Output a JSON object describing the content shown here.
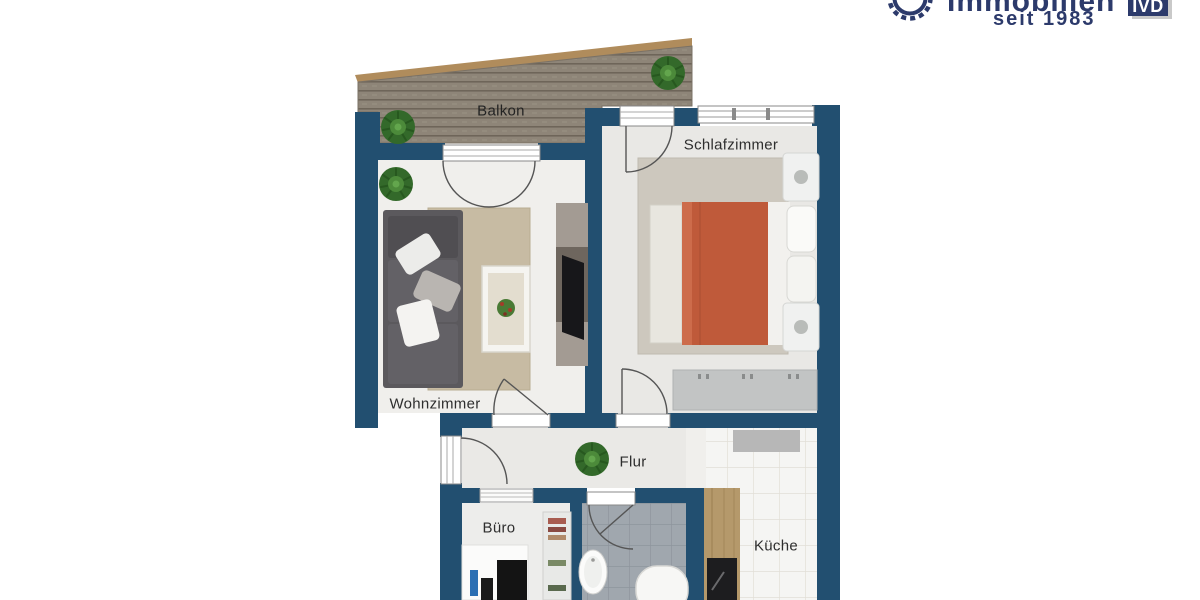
{
  "logo": {
    "brand": "Immobilien",
    "tagline": "seit 1983",
    "badge": "IVD",
    "icon": "gear-ring-icon"
  },
  "floorplan": {
    "type": "apartment-floor-plan",
    "rooms": [
      {
        "id": "balkon",
        "label": "Balkon"
      },
      {
        "id": "schlafzimmer",
        "label": "Schlafzimmer"
      },
      {
        "id": "wohnzimmer",
        "label": "Wohnzimmer"
      },
      {
        "id": "flur",
        "label": "Flur"
      },
      {
        "id": "buero",
        "label": "Büro"
      },
      {
        "id": "kueche",
        "label": "Küche"
      }
    ],
    "furniture": [
      "balcony-deck",
      "sofa",
      "rug",
      "coffee-table",
      "tv-sideboard",
      "bed",
      "nightstands",
      "wardrobe",
      "hall-plant",
      "desk",
      "shelf",
      "sink",
      "bathtub",
      "kitchen-counter",
      "stove"
    ],
    "colors": {
      "wall": "#224f70",
      "deck": "#8e8578",
      "deck_border": "#b08c5c",
      "brand_navy": "#2c3a6b",
      "bed_duvet": "#bf5a3a",
      "floor_light": "#efeeec",
      "bath_tile": "#a0a7ae",
      "kitchen_tile": "#f5f5f3",
      "counter_wood": "#b5996b",
      "sofa_gray": "#5b595d",
      "rug_beige": "#c7bba3"
    }
  }
}
